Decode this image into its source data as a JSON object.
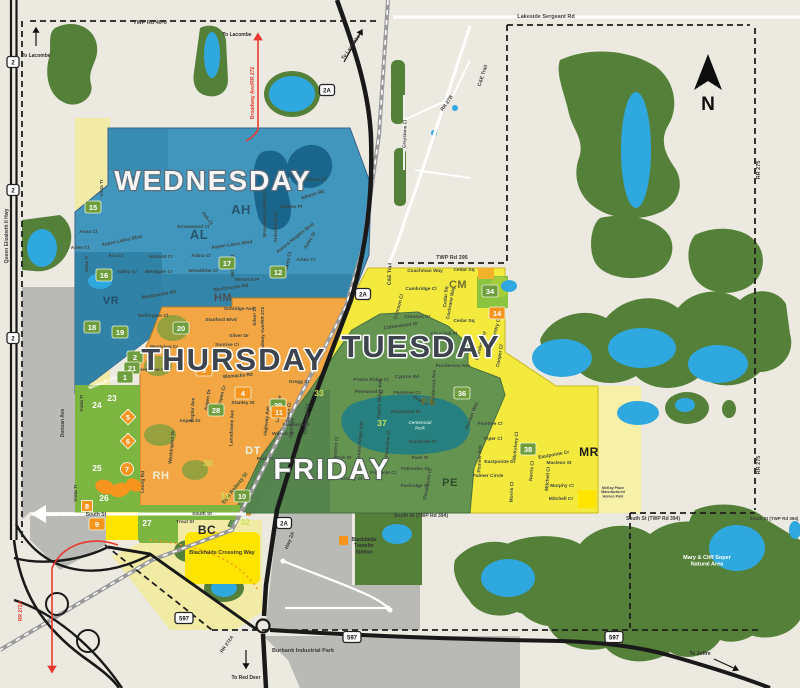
{
  "palette": {
    "bg": "#ECEAE0",
    "forest": "#55803A",
    "water": "#2FA8E0",
    "pond": "#19658B",
    "wedDark": "#2F7FA3",
    "thuDark": "#D8912D",
    "friPark": "#1F7E83",
    "dtDark": "#49784A",
    "lime": "#8BC53F",
    "limeText": "#C8E05A",
    "brightYellow": "#FFE400",
    "paleYellow": "#F1EBA6",
    "mrYellow": "#F6F0A8",
    "gray": "#B9B9B5",
    "road": "#191919",
    "red": "#E8392F",
    "rail": "#999999",
    "markGreen": "#6F9E3E",
    "markOrange": "#F7941E",
    "labelDark": "#3A444C"
  },
  "compass": {
    "label": "N"
  },
  "day_zones": [
    {
      "id": "wednesday",
      "label": "WEDNESDAY",
      "x": 213,
      "y": 190,
      "fs": 28,
      "fill": "#F4F6F7",
      "stroke": "#5E6E79",
      "sw": 2.6,
      "color": "#4196BD"
    },
    {
      "id": "thursday",
      "label": "THURSDAY",
      "x": 234,
      "y": 370,
      "fs": 31,
      "fill": "#3E444D",
      "stroke": "#FFFFFF",
      "sw": 3,
      "color": "#F2A644"
    },
    {
      "id": "tuesday",
      "label": "TUESDAY",
      "x": 421,
      "y": 357,
      "fs": 31,
      "fill": "#3E444D",
      "stroke": "#FFFFFF",
      "sw": 3,
      "color": "#F4EA3E"
    },
    {
      "id": "friday",
      "label": "FRIDAY",
      "x": 332,
      "y": 479,
      "fs": 29,
      "fill": "#FDFDFD",
      "stroke": "#4F6253",
      "sw": 2.4,
      "color": "#5E9053"
    }
  ],
  "area_codes": [
    {
      "t": "AH",
      "x": 294,
      "y": 178,
      "fs": 9,
      "c": "#27556E"
    },
    {
      "t": "AH",
      "x": 241,
      "y": 214,
      "fs": 13,
      "c": "#27556E"
    },
    {
      "t": "AL",
      "x": 131,
      "y": 184,
      "fs": 11,
      "c": "#27556E"
    },
    {
      "t": "AL",
      "x": 199,
      "y": 239,
      "fs": 13,
      "c": "#27556E"
    },
    {
      "t": "VR",
      "x": 111,
      "y": 304,
      "fs": 11,
      "c": "#24506B"
    },
    {
      "t": "HM",
      "x": 223,
      "y": 301,
      "fs": 11,
      "c": "#4E4E52"
    },
    {
      "t": "CM",
      "x": 458,
      "y": 288,
      "fs": 11,
      "c": "#70712F"
    },
    {
      "t": "PE",
      "x": 429,
      "y": 405,
      "fs": 11,
      "c": "#6F7030"
    },
    {
      "t": "PE",
      "x": 450,
      "y": 486,
      "fs": 11,
      "c": "#2F4A28"
    },
    {
      "t": "DT",
      "x": 253,
      "y": 454,
      "fs": 11,
      "c": "#E9F1E6"
    },
    {
      "t": "RH",
      "x": 161,
      "y": 479,
      "fs": 11,
      "c": "#F6EAD2"
    },
    {
      "t": "BC",
      "x": 207,
      "y": 534,
      "fs": 12,
      "c": "#262626"
    },
    {
      "t": "MR",
      "x": 589,
      "y": 456,
      "fs": 12,
      "c": "#1C1C1C"
    }
  ],
  "markers": [
    {
      "t": "12",
      "x": 278,
      "y": 272,
      "s": "g"
    },
    {
      "t": "15",
      "x": 93,
      "y": 207,
      "s": "g"
    },
    {
      "t": "16",
      "x": 104,
      "y": 275,
      "s": "g"
    },
    {
      "t": "17",
      "x": 227,
      "y": 263,
      "s": "g"
    },
    {
      "t": "18",
      "x": 92,
      "y": 327,
      "s": "g"
    },
    {
      "t": "19",
      "x": 120,
      "y": 332,
      "s": "g"
    },
    {
      "t": "20",
      "x": 181,
      "y": 328,
      "s": "g"
    },
    {
      "t": "2",
      "x": 135,
      "y": 357,
      "s": "g"
    },
    {
      "t": "21",
      "x": 132,
      "y": 368,
      "s": "g"
    },
    {
      "t": "1",
      "x": 125,
      "y": 377,
      "s": "g"
    },
    {
      "t": "28",
      "x": 216,
      "y": 410,
      "s": "g"
    },
    {
      "t": "29",
      "x": 278,
      "y": 405,
      "s": "g"
    },
    {
      "t": "10",
      "x": 242,
      "y": 496,
      "s": "g"
    },
    {
      "t": "36",
      "x": 462,
      "y": 393,
      "s": "g"
    },
    {
      "t": "38",
      "x": 528,
      "y": 449,
      "s": "g"
    },
    {
      "t": "34",
      "x": 490,
      "y": 291,
      "s": "g"
    },
    {
      "t": "3",
      "x": 204,
      "y": 370,
      "s": "o"
    },
    {
      "t": "4",
      "x": 243,
      "y": 393,
      "s": "o"
    },
    {
      "t": "11",
      "x": 279,
      "y": 412,
      "s": "o"
    },
    {
      "t": "9",
      "x": 97,
      "y": 524,
      "s": "o"
    },
    {
      "t": "14",
      "x": 497,
      "y": 313,
      "s": "o"
    },
    {
      "t": "5",
      "x": 128,
      "y": 417,
      "s": "d"
    },
    {
      "t": "6",
      "x": 128,
      "y": 441,
      "s": "d"
    },
    {
      "t": "7",
      "x": 127,
      "y": 469,
      "s": "c"
    },
    {
      "t": "8",
      "x": 87,
      "y": 506,
      "s": "q"
    },
    {
      "t": "23",
      "x": 112,
      "y": 398,
      "s": "w"
    },
    {
      "t": "24",
      "x": 97,
      "y": 405,
      "s": "w"
    },
    {
      "t": "25",
      "x": 97,
      "y": 468,
      "s": "w"
    },
    {
      "t": "26",
      "x": 104,
      "y": 498,
      "s": "w"
    },
    {
      "t": "27",
      "x": 147,
      "y": 523,
      "s": "w"
    },
    {
      "t": "33",
      "x": 319,
      "y": 393,
      "s": "l"
    },
    {
      "t": "30",
      "x": 208,
      "y": 463,
      "s": "l"
    },
    {
      "t": "31",
      "x": 225,
      "y": 496,
      "s": "l"
    },
    {
      "t": "32",
      "x": 245,
      "y": 522,
      "s": "l"
    },
    {
      "t": "37",
      "x": 382,
      "y": 423,
      "s": "l"
    }
  ],
  "road_labels": [
    {
      "t": "TWP Rd 40-0",
      "x": 150,
      "y": 24,
      "fs": 5.5
    },
    {
      "t": "Lakeside Sergeant Rd",
      "x": 546,
      "y": 18,
      "fs": 5.5
    },
    {
      "t": "TWP Rd 395",
      "x": 452,
      "y": 259,
      "fs": 5.5
    },
    {
      "t": "RR 275",
      "x": 760,
      "y": 170,
      "r": -90,
      "fs": 5.5
    },
    {
      "t": "RR 275",
      "x": 760,
      "y": 465,
      "r": -90,
      "fs": 5.5
    },
    {
      "t": "Queen Elizabeth II Hwy",
      "x": 8,
      "y": 236,
      "r": -90,
      "fs": 5
    },
    {
      "t": "Broadway Ave/RR 272",
      "x": 254,
      "y": 93,
      "r": -90,
      "fs": 5,
      "c": "#E8392F"
    },
    {
      "t": "C&E Trail",
      "x": 484,
      "y": 76,
      "r": -72,
      "fs": 5
    },
    {
      "t": "C&E Trail",
      "x": 391,
      "y": 274,
      "r": -88,
      "fs": 5
    },
    {
      "t": "RR 27B",
      "x": 448,
      "y": 104,
      "r": -55,
      "fs": 5
    },
    {
      "t": "Greystone Cl",
      "x": 406,
      "y": 134,
      "r": -88,
      "f s": 4.5,
      "fs": 4.5
    },
    {
      "t": "South St",
      "x": 56,
      "y": 516,
      "fs": 5,
      "c": "#FFFFFF"
    },
    {
      "t": "South St",
      "x": 96,
      "y": 516,
      "fs": 5
    },
    {
      "t": "South St",
      "x": 202,
      "y": 515,
      "fs": 4.8
    },
    {
      "t": "South St (TWP Rd 394)",
      "x": 421,
      "y": 517,
      "fs": 5
    },
    {
      "t": "South St (TWP Rd 394)",
      "x": 653,
      "y": 520,
      "fs": 5
    },
    {
      "t": "South St (TWP Rd 394)",
      "x": 774,
      "y": 520,
      "fs": 4.5
    },
    {
      "t": "Duncan Ave",
      "x": 64,
      "y": 423,
      "r": -90,
      "fs": 5
    },
    {
      "t": "Vista Tr",
      "x": 83,
      "y": 403,
      "r": -90,
      "fs": 4.8
    },
    {
      "t": "Vista Tr",
      "x": 77,
      "y": 493,
      "r": -90,
      "fs": 4.8
    },
    {
      "t": "East Railway St",
      "x": 236,
      "y": 489,
      "r": -52,
      "fs": 5.2,
      "c": "#2E5A33"
    },
    {
      "t": "RR 272A",
      "x": 22,
      "y": 611,
      "r": -90,
      "fs": 5,
      "c": "#E8392F"
    },
    {
      "t": "RR 272A",
      "x": 228,
      "y": 645,
      "r": -55,
      "fs": 4.8
    },
    {
      "t": "Hwy 2A",
      "x": 291,
      "y": 541,
      "r": -68,
      "fs": 5
    }
  ],
  "street_labels": [
    {
      "t": "Vista Tr",
      "x": 103,
      "y": 188,
      "r": -90
    },
    {
      "t": "Anna Cl",
      "x": 88,
      "y": 233
    },
    {
      "t": "Arlen Cl",
      "x": 80,
      "y": 249
    },
    {
      "t": "Aspen Lakes Blvd",
      "x": 122,
      "y": 242,
      "r": -12
    },
    {
      "t": "Ava Cr",
      "x": 116,
      "y": 257
    },
    {
      "t": "Vista Tr",
      "x": 88,
      "y": 264,
      "r": -90
    },
    {
      "t": "Valley Cr",
      "x": 127,
      "y": 273
    },
    {
      "t": "Westgate Cr",
      "x": 159,
      "y": 273
    },
    {
      "t": "Almond Cr",
      "x": 161,
      "y": 258
    },
    {
      "t": "Adina Cl",
      "x": 201,
      "y": 257
    },
    {
      "t": "Woodbine Cl",
      "x": 203,
      "y": 272
    },
    {
      "t": "Arrowwood Cl",
      "x": 193,
      "y": 228
    },
    {
      "t": "Ash Cl",
      "x": 206,
      "y": 219,
      "r": 55
    },
    {
      "t": "Aspen Lakes Blvd",
      "x": 232,
      "y": 246,
      "r": -8
    },
    {
      "t": "Willow Rd",
      "x": 234,
      "y": 266,
      "r": -90
    },
    {
      "t": "Winston Pl",
      "x": 247,
      "y": 281
    },
    {
      "t": "Westbrooke Rd",
      "x": 231,
      "y": 289,
      "r": -8
    },
    {
      "t": "Westbrooke Rd",
      "x": 159,
      "y": 296,
      "r": -10
    },
    {
      "t": "Athens Pl",
      "x": 315,
      "y": 181
    },
    {
      "t": "Athens Rd",
      "x": 313,
      "y": 196,
      "r": -18
    },
    {
      "t": "Athens Pl",
      "x": 291,
      "y": 208
    },
    {
      "t": "Alderwood Cl",
      "x": 277,
      "y": 227,
      "r": -90
    },
    {
      "t": "Aurora Heights Blvd",
      "x": 296,
      "y": 239,
      "r": -38
    },
    {
      "t": "Aztec St",
      "x": 311,
      "y": 241,
      "r": -60
    },
    {
      "t": "Aztec Cr",
      "x": 306,
      "y": 261
    },
    {
      "t": "Adams Cl",
      "x": 289,
      "y": 263,
      "r": -78
    },
    {
      "t": "Broadway Ave/RR 272",
      "x": 266,
      "y": 212,
      "r": -90
    },
    {
      "t": "Wellington Cl",
      "x": 153,
      "y": 317
    },
    {
      "t": "Sunridge Ave",
      "x": 239,
      "y": 310
    },
    {
      "t": "Stanford Blvd",
      "x": 221,
      "y": 321
    },
    {
      "t": "Silver Dr",
      "x": 256,
      "y": 316,
      "r": -90
    },
    {
      "t": "Silver Dr",
      "x": 239,
      "y": 337
    },
    {
      "t": "Sunrise Cl",
      "x": 227,
      "y": 346
    },
    {
      "t": "Westview Cr",
      "x": 164,
      "y": 348
    },
    {
      "t": "Westview Cr",
      "x": 152,
      "y": 371
    },
    {
      "t": "Womacks Rd",
      "x": 238,
      "y": 377,
      "r": -5
    },
    {
      "t": "Womacks Rd",
      "x": 103,
      "y": 384,
      "r": -22,
      "c": "#FFFFFF"
    },
    {
      "t": "Gregg St",
      "x": 299,
      "y": 383
    },
    {
      "t": "Stanley St",
      "x": 243,
      "y": 404
    },
    {
      "t": "Aspen Dr",
      "x": 190,
      "y": 422
    },
    {
      "t": "Aspen Dr",
      "x": 209,
      "y": 400,
      "r": -80
    },
    {
      "t": "Poplar Ave",
      "x": 194,
      "y": 410,
      "r": -88
    },
    {
      "t": "Aspen Cr",
      "x": 223,
      "y": 396,
      "r": -75
    },
    {
      "t": "Lansdowne Ave",
      "x": 233,
      "y": 428,
      "r": -88
    },
    {
      "t": "Washington Dr",
      "x": 173,
      "y": 447,
      "r": -85
    },
    {
      "t": "Leung Rd",
      "x": 144,
      "y": 482,
      "r": -88
    },
    {
      "t": "Broadway Ave/RR 272",
      "x": 264,
      "y": 332,
      "r": -90
    },
    {
      "t": "Coachman Way",
      "x": 425,
      "y": 272
    },
    {
      "t": "Cedar Sq",
      "x": 464,
      "y": 271
    },
    {
      "t": "Cambridge Cl",
      "x": 421,
      "y": 290
    },
    {
      "t": "Crimson Cl",
      "x": 400,
      "y": 307,
      "r": -75
    },
    {
      "t": "Crimson Cl",
      "x": 417,
      "y": 318
    },
    {
      "t": "Cochrane Way",
      "x": 452,
      "y": 303,
      "r": -80
    },
    {
      "t": "Cedar Sq",
      "x": 447,
      "y": 297,
      "r": -85
    },
    {
      "t": "Cedar Sq",
      "x": 464,
      "y": 322
    },
    {
      "t": "Cottonwood Dr",
      "x": 401,
      "y": 327,
      "r": -8
    },
    {
      "t": "Churchill Pl",
      "x": 444,
      "y": 335
    },
    {
      "t": "Coventry Cl",
      "x": 497,
      "y": 331,
      "r": -75
    },
    {
      "t": "Camden Way",
      "x": 482,
      "y": 346,
      "r": -75
    },
    {
      "t": "Cooper Cl",
      "x": 501,
      "y": 356,
      "r": -80
    },
    {
      "t": "Ponderosa Ave",
      "x": 453,
      "y": 367
    },
    {
      "t": "Ponderosa Ave",
      "x": 435,
      "y": 387,
      "r": -88
    },
    {
      "t": "Cyprus Rd",
      "x": 407,
      "y": 378
    },
    {
      "t": "Plumtree Cr",
      "x": 407,
      "y": 394
    },
    {
      "t": "Pine Cr",
      "x": 420,
      "y": 402,
      "r": 28
    },
    {
      "t": "Prairie Ridge Cl",
      "x": 371,
      "y": 381
    },
    {
      "t": "Prairie Ridge Ave",
      "x": 381,
      "y": 399,
      "r": -88
    },
    {
      "t": "Pinewood Cl",
      "x": 369,
      "y": 393
    },
    {
      "t": "Pioneer Way",
      "x": 473,
      "y": 416,
      "r": -70
    },
    {
      "t": "Pinetree Cl",
      "x": 490,
      "y": 425
    },
    {
      "t": "Piper Cl",
      "x": 493,
      "y": 440
    },
    {
      "t": "Pioneer Ave",
      "x": 481,
      "y": 459,
      "r": -88
    },
    {
      "t": "Eastpointe Dr",
      "x": 500,
      "y": 463
    },
    {
      "t": "Palmer Circle",
      "x": 488,
      "y": 477
    },
    {
      "t": "McKelvey Cl",
      "x": 517,
      "y": 446,
      "r": -85
    },
    {
      "t": "Morris Cl",
      "x": 513,
      "y": 492,
      "r": -88
    },
    {
      "t": "Norris Cl",
      "x": 533,
      "y": 471,
      "r": -85
    },
    {
      "t": "Eastpointe Cr",
      "x": 554,
      "y": 456,
      "r": -10
    },
    {
      "t": "Maclean St",
      "x": 559,
      "y": 464
    },
    {
      "t": "Mitchell Cl",
      "x": 549,
      "y": 479,
      "r": -85
    },
    {
      "t": "Murphy Cl",
      "x": 562,
      "y": 487
    },
    {
      "t": "Mitchell Cr",
      "x": 561,
      "y": 500
    },
    {
      "t": "Panorama Dr",
      "x": 406,
      "y": 413
    },
    {
      "t": "Pondside Cr",
      "x": 423,
      "y": 443
    },
    {
      "t": "Park St",
      "x": 420,
      "y": 459
    },
    {
      "t": "Palisades St",
      "x": 415,
      "y": 470
    },
    {
      "t": "Parkridge Cr",
      "x": 415,
      "y": 487
    },
    {
      "t": "Paramount Cr",
      "x": 429,
      "y": 484,
      "r": -80
    },
    {
      "t": "Parkview Cl",
      "x": 389,
      "y": 444,
      "r": -85
    },
    {
      "t": "Panorama Ridge Ave",
      "x": 361,
      "y": 445,
      "r": -85
    },
    {
      "t": "Parkwood Rd",
      "x": 308,
      "y": 419,
      "r": -85
    },
    {
      "t": "Prospect Cl",
      "x": 337,
      "y": 450,
      "r": -85
    },
    {
      "t": "Park St",
      "x": 343,
      "y": 459
    },
    {
      "t": "Pinnacle Cl",
      "x": 383,
      "y": 474
    },
    {
      "t": "Portway Cl",
      "x": 350,
      "y": 480
    },
    {
      "t": "Waghorn St",
      "x": 296,
      "y": 426
    },
    {
      "t": "Wilson St",
      "x": 283,
      "y": 435
    },
    {
      "t": "Park St",
      "x": 265,
      "y": 460
    },
    {
      "t": "East Ave",
      "x": 293,
      "y": 428,
      "r": -85
    },
    {
      "t": "Lamont Ave",
      "x": 280,
      "y": 409,
      "r": -85
    },
    {
      "t": "Queen Cl",
      "x": 290,
      "y": 413,
      "r": -85
    },
    {
      "t": "Highway Ave",
      "x": 268,
      "y": 421,
      "r": -85
    },
    {
      "t": "Trout St",
      "x": 185,
      "y": 523
    }
  ],
  "places": [
    {
      "name": "blackfalds-crossing-way",
      "lines": [
        "Blackfalds Crossing Way"
      ],
      "x": 222,
      "y": 554,
      "fs": 5.5,
      "c": "#3A3A2A",
      "lh": 6
    },
    {
      "name": "blackfalds-transfer-station",
      "lines": [
        "Blackfalds",
        "Transfer",
        "Station"
      ],
      "x": 364,
      "y": 541,
      "fs": 5,
      "c": "#2F2F2F",
      "lh": 6.2,
      "swatch": "#F7941E"
    },
    {
      "name": "burbank-industrial-park",
      "lines": [
        "Burbank Industrial Park"
      ],
      "x": 303,
      "y": 652,
      "fs": 5.5,
      "c": "#3C3C3C",
      "lh": 6
    },
    {
      "name": "mary-cliff-soper-natural-area",
      "lines": [
        "Mary & Cliff Soper",
        "Natural Area"
      ],
      "x": 707,
      "y": 559,
      "fs": 5.5,
      "c": "#FFFFFF",
      "lh": 6.5
    },
    {
      "name": "centennial-park",
      "lines": [
        "Centennial",
        "Park"
      ],
      "x": 420,
      "y": 424,
      "fs": 4.5,
      "c": "#B8E0D8",
      "lh": 5.5,
      "italic": true
    },
    {
      "name": "mckay-place",
      "lines": [
        "McKay Place",
        "Manufactured",
        "Homes Park"
      ],
      "x": 613,
      "y": 489,
      "fs": 3.6,
      "c": "#444444",
      "lh": 4.2
    }
  ],
  "directions": [
    {
      "t": "To Lacombe",
      "x": 36,
      "y": 57,
      "fs": 5,
      "arrow": [
        36,
        46,
        36,
        28
      ]
    },
    {
      "t": "To Lacombe",
      "x": 237,
      "y": 36,
      "fs": 5
    },
    {
      "t": "To Lacombe",
      "x": 352,
      "y": 48,
      "r": -55,
      "fs": 5,
      "arrow": [
        344,
        62,
        362,
        30
      ]
    },
    {
      "t": "To Red Deer",
      "x": 246,
      "y": 679,
      "fs": 5,
      "arrow": [
        246,
        650,
        246,
        668
      ]
    },
    {
      "t": "To Joffre",
      "x": 700,
      "y": 655,
      "fs": 5,
      "arrow": [
        714,
        659,
        738,
        670
      ]
    }
  ],
  "shields": [
    {
      "t": "2",
      "x": 13,
      "y": 62
    },
    {
      "t": "2",
      "x": 13,
      "y": 190
    },
    {
      "t": "2",
      "x": 13,
      "y": 338
    },
    {
      "t": "2A",
      "x": 327,
      "y": 90
    },
    {
      "t": "2A",
      "x": 363,
      "y": 294
    },
    {
      "t": "2A",
      "x": 284,
      "y": 523
    },
    {
      "t": "597",
      "x": 184,
      "y": 618
    },
    {
      "t": "597",
      "x": 352,
      "y": 637
    },
    {
      "t": "597",
      "x": 614,
      "y": 637
    }
  ]
}
